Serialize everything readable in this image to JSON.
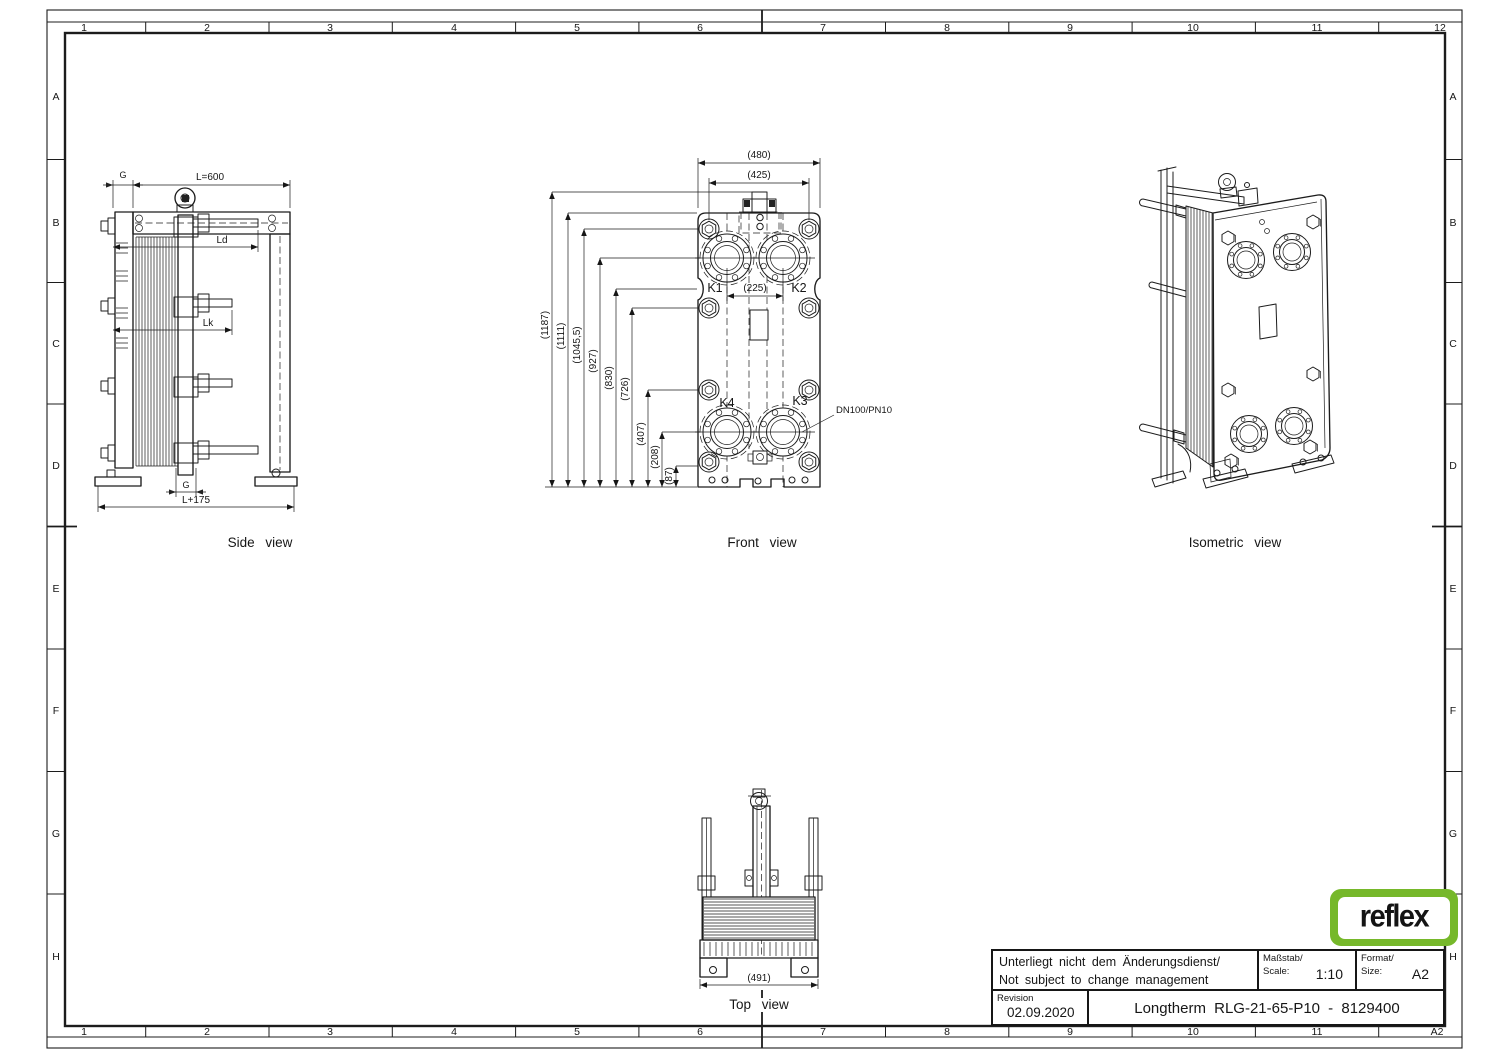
{
  "sheet": {
    "cols": [
      "1",
      "2",
      "3",
      "4",
      "5",
      "6",
      "7",
      "8",
      "9",
      "10",
      "11",
      "12"
    ],
    "cols_bottom": [
      "1",
      "2",
      "3",
      "4",
      "5",
      "6",
      "7",
      "8",
      "9",
      "10",
      "11",
      "A2"
    ],
    "rows": [
      "A",
      "B",
      "C",
      "D",
      "E",
      "F",
      "G",
      "H"
    ]
  },
  "views": {
    "side": {
      "label": "Side view",
      "g_top": "G",
      "length": "L=600",
      "ld": "Ld",
      "lk": "Lk",
      "g_bottom": "G",
      "overall": "L+175"
    },
    "front": {
      "label": "Front view",
      "dim_width_outer": "(480)",
      "dim_width_inner": "(425)",
      "dim_port_spacing": "(225)",
      "k1": "K1",
      "k2": "K2",
      "k3": "K3",
      "k4": "K4",
      "nozzle": "DN100/PN10",
      "vdims": [
        "(1187)",
        "(1111)",
        "(1045,5)",
        "(927)",
        "(830)",
        "(726)",
        "(407)",
        "(208)",
        "(87)"
      ]
    },
    "top": {
      "label": "Top view",
      "dim_width": "(491)"
    },
    "iso": {
      "label": "Isometric view"
    }
  },
  "title_block": {
    "note_line1": "Unterliegt nicht dem Änderungsdienst/",
    "note_line2": "Not subject to change management",
    "scale_label_de": "Maßstab/",
    "scale_label_en": "Scale:",
    "scale_value": "1:10",
    "format_label_de": "Format/",
    "format_label_en": "Size:",
    "format_value": "A2",
    "revision_label": "Revision",
    "revision_date": "02.09.2020",
    "drawing_title": "Longtherm RLG-21-65-P10 - 8129400"
  },
  "logo": {
    "text": "reflex",
    "brand_green": "#76b82a"
  }
}
